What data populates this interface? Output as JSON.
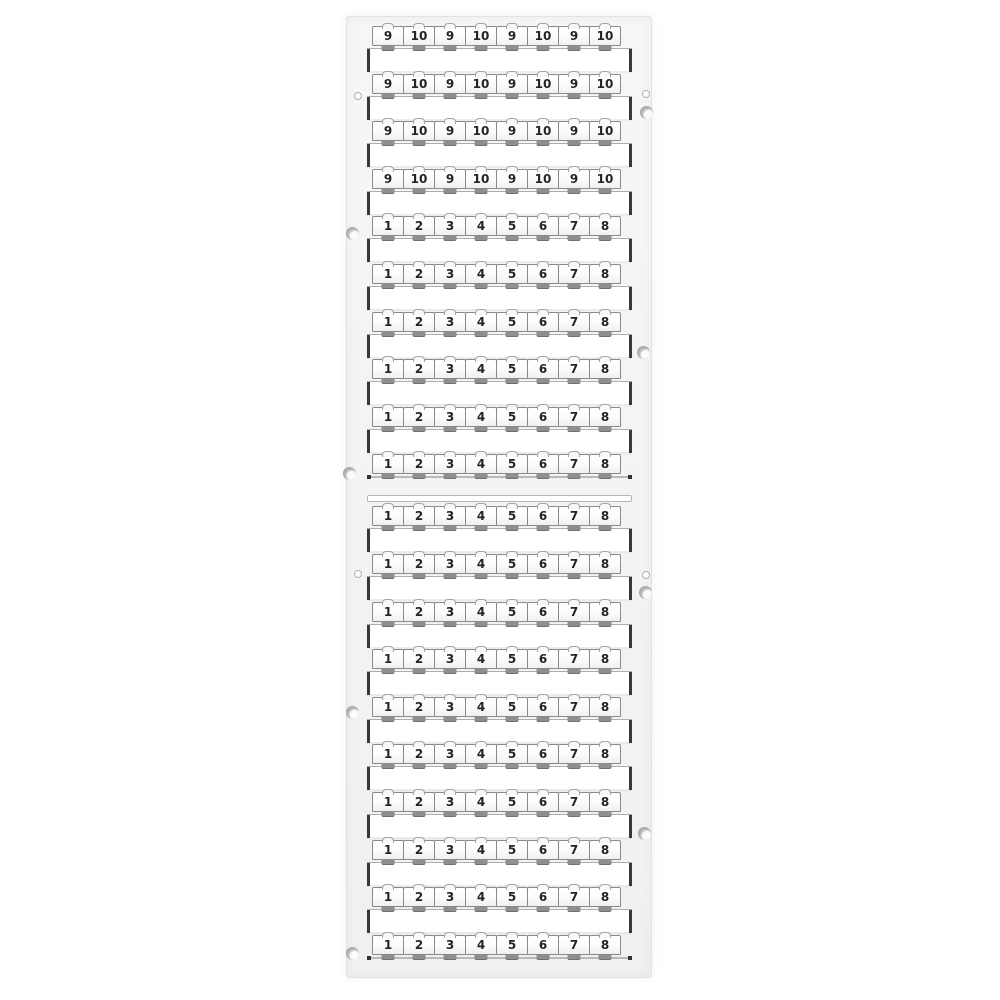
{
  "product": {
    "name": "terminal-marker-card",
    "description": "White plastic terminal block marker card with rows of snap-off numbered marker tags, mounted in a frame with side rails, round mounting holes and molded studs",
    "marker_rows_total": 20,
    "markers_per_row": 8
  },
  "colors": {
    "background": "#ffffff",
    "card": "#f4f4f4",
    "marker_tag": "#fbfbfb",
    "tag_border": "#8a8a8a",
    "digit": "#242424",
    "strip_end_cap": "#383838",
    "snap_tab": "#8f8f8f"
  },
  "sections": [
    {
      "name": "upper-half",
      "rows": [
        [
          "9",
          "10",
          "9",
          "10",
          "9",
          "10",
          "9",
          "10"
        ],
        [
          "9",
          "10",
          "9",
          "10",
          "9",
          "10",
          "9",
          "10"
        ],
        [
          "9",
          "10",
          "9",
          "10",
          "9",
          "10",
          "9",
          "10"
        ],
        [
          "9",
          "10",
          "9",
          "10",
          "9",
          "10",
          "9",
          "10"
        ],
        [
          "1",
          "2",
          "3",
          "4",
          "5",
          "6",
          "7",
          "8"
        ],
        [
          "1",
          "2",
          "3",
          "4",
          "5",
          "6",
          "7",
          "8"
        ],
        [
          "1",
          "2",
          "3",
          "4",
          "5",
          "6",
          "7",
          "8"
        ],
        [
          "1",
          "2",
          "3",
          "4",
          "5",
          "6",
          "7",
          "8"
        ],
        [
          "1",
          "2",
          "3",
          "4",
          "5",
          "6",
          "7",
          "8"
        ],
        [
          "1",
          "2",
          "3",
          "4",
          "5",
          "6",
          "7",
          "8"
        ]
      ]
    },
    {
      "name": "lower-half",
      "rows": [
        [
          "1",
          "2",
          "3",
          "4",
          "5",
          "6",
          "7",
          "8"
        ],
        [
          "1",
          "2",
          "3",
          "4",
          "5",
          "6",
          "7",
          "8"
        ],
        [
          "1",
          "2",
          "3",
          "4",
          "5",
          "6",
          "7",
          "8"
        ],
        [
          "1",
          "2",
          "3",
          "4",
          "5",
          "6",
          "7",
          "8"
        ],
        [
          "1",
          "2",
          "3",
          "4",
          "5",
          "6",
          "7",
          "8"
        ],
        [
          "1",
          "2",
          "3",
          "4",
          "5",
          "6",
          "7",
          "8"
        ],
        [
          "1",
          "2",
          "3",
          "4",
          "5",
          "6",
          "7",
          "8"
        ],
        [
          "1",
          "2",
          "3",
          "4",
          "5",
          "6",
          "7",
          "8"
        ],
        [
          "1",
          "2",
          "3",
          "4",
          "5",
          "6",
          "7",
          "8"
        ],
        [
          "1",
          "2",
          "3",
          "4",
          "5",
          "6",
          "7",
          "8"
        ]
      ]
    }
  ]
}
